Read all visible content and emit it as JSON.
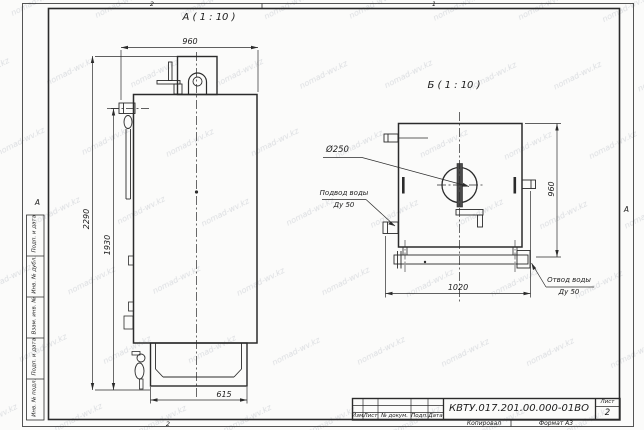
{
  "sheet": {
    "watermark": "nomad-wv.kz",
    "zones": {
      "top_left": "2",
      "top_right": "1",
      "bottom_left": "2"
    },
    "side_marker": "А",
    "margin_boxes": [
      "Подп. и дата",
      "Инв. № дубл.",
      "Взам. инв. №",
      "Подп. и дата",
      "Инв. № подл."
    ]
  },
  "views": {
    "front": {
      "title": "А ( 1 : 10 )",
      "dim_width_top": "960",
      "dim_height_overall": "2290",
      "dim_height_body": "1930",
      "dim_base_width": "615"
    },
    "back": {
      "title": "Б ( 1 : 10 )",
      "dim_flue_diameter": "Ø250",
      "dim_height": "960",
      "dim_span": "1020",
      "inlet_label": "Подвод воды",
      "inlet_dn": "Ду 50",
      "outlet_label": "Отвод воды",
      "outlet_dn": "Ду 50"
    }
  },
  "title_block": {
    "designation": "КВТУ.017.201.00.000-01ВО",
    "sheet_label": "Лист",
    "sheet_number": "2",
    "col_izm": "Изм.",
    "col_list": "Лист",
    "col_doc": "№ докум.",
    "col_sign": "Подп.",
    "col_date": "Дата",
    "footer_copy": "Копировал",
    "footer_format": "Формат А3"
  }
}
